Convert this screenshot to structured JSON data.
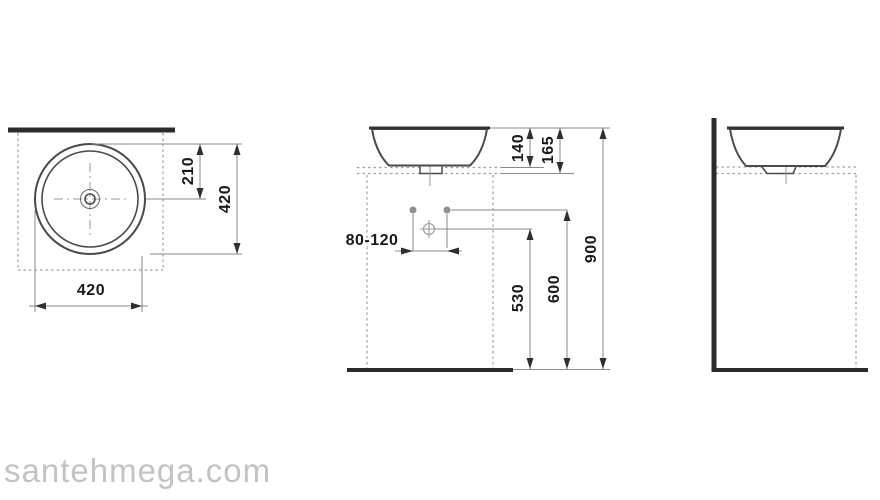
{
  "page": {
    "watermark": "santehmega.com",
    "background": "#ffffff"
  },
  "drawing": {
    "subject": "round countertop washbasin, three-view dimensional drawing",
    "views": {
      "top": {
        "label_width": "420",
        "label_depth": "420",
        "label_center_offset": "210"
      },
      "front": {
        "label_basin_height": "140",
        "label_rim_height": "165",
        "label_total_height": "900",
        "label_supply_height": "600",
        "label_drain_height": "530",
        "label_drain_range": "80-120"
      }
    },
    "colors": {
      "line_thick": "#2b2b2b",
      "line_outline": "#4a4a4a",
      "line_dim": "#8a8a8a",
      "line_dashed": "#a0a0a0",
      "arrow": "#2f2f2f",
      "text": "#1a1a1a",
      "watermark": "#c3c3c3"
    }
  }
}
